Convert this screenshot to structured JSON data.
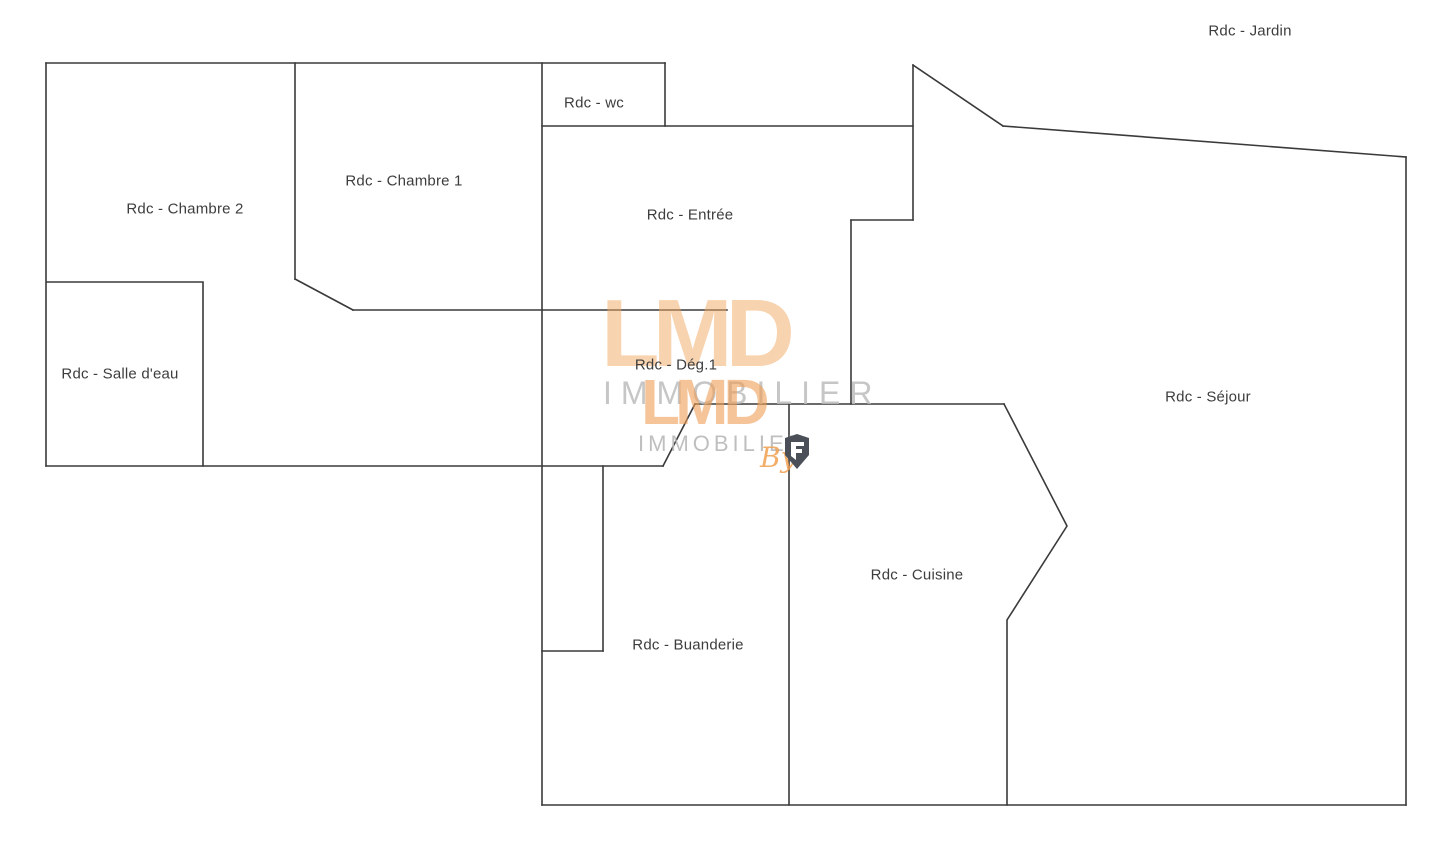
{
  "page": {
    "background": "#ffffff",
    "wall_color": "#3a3a3a",
    "label_color": "#3d3d3d"
  },
  "rooms": [
    {
      "id": "jardin",
      "label": "Rdc - Jardin"
    },
    {
      "id": "wc",
      "label": "Rdc - wc"
    },
    {
      "id": "chambre-1",
      "label": "Rdc - Chambre 1"
    },
    {
      "id": "chambre-2",
      "label": "Rdc - Chambre 2"
    },
    {
      "id": "entree",
      "label": "Rdc - Entrée"
    },
    {
      "id": "salle-eau",
      "label": "Rdc - Salle d'eau"
    },
    {
      "id": "deg-1",
      "label": "Rdc - Dég.1"
    },
    {
      "id": "sejour",
      "label": "Rdc - Séjour"
    },
    {
      "id": "cuisine",
      "label": "Rdc - Cuisine"
    },
    {
      "id": "buanderie",
      "label": "Rdc - Buanderie"
    }
  ],
  "watermark": {
    "brand": "LMD",
    "brand_repeat": "LMD",
    "subtitle": "IMMOBILIER",
    "subtitle_repeat": "IMMOBILIER",
    "by_label": "By",
    "accent_color": "#f0a45e",
    "subtitle_color": "#bdbdbd",
    "shield_color": "#4b5058"
  }
}
